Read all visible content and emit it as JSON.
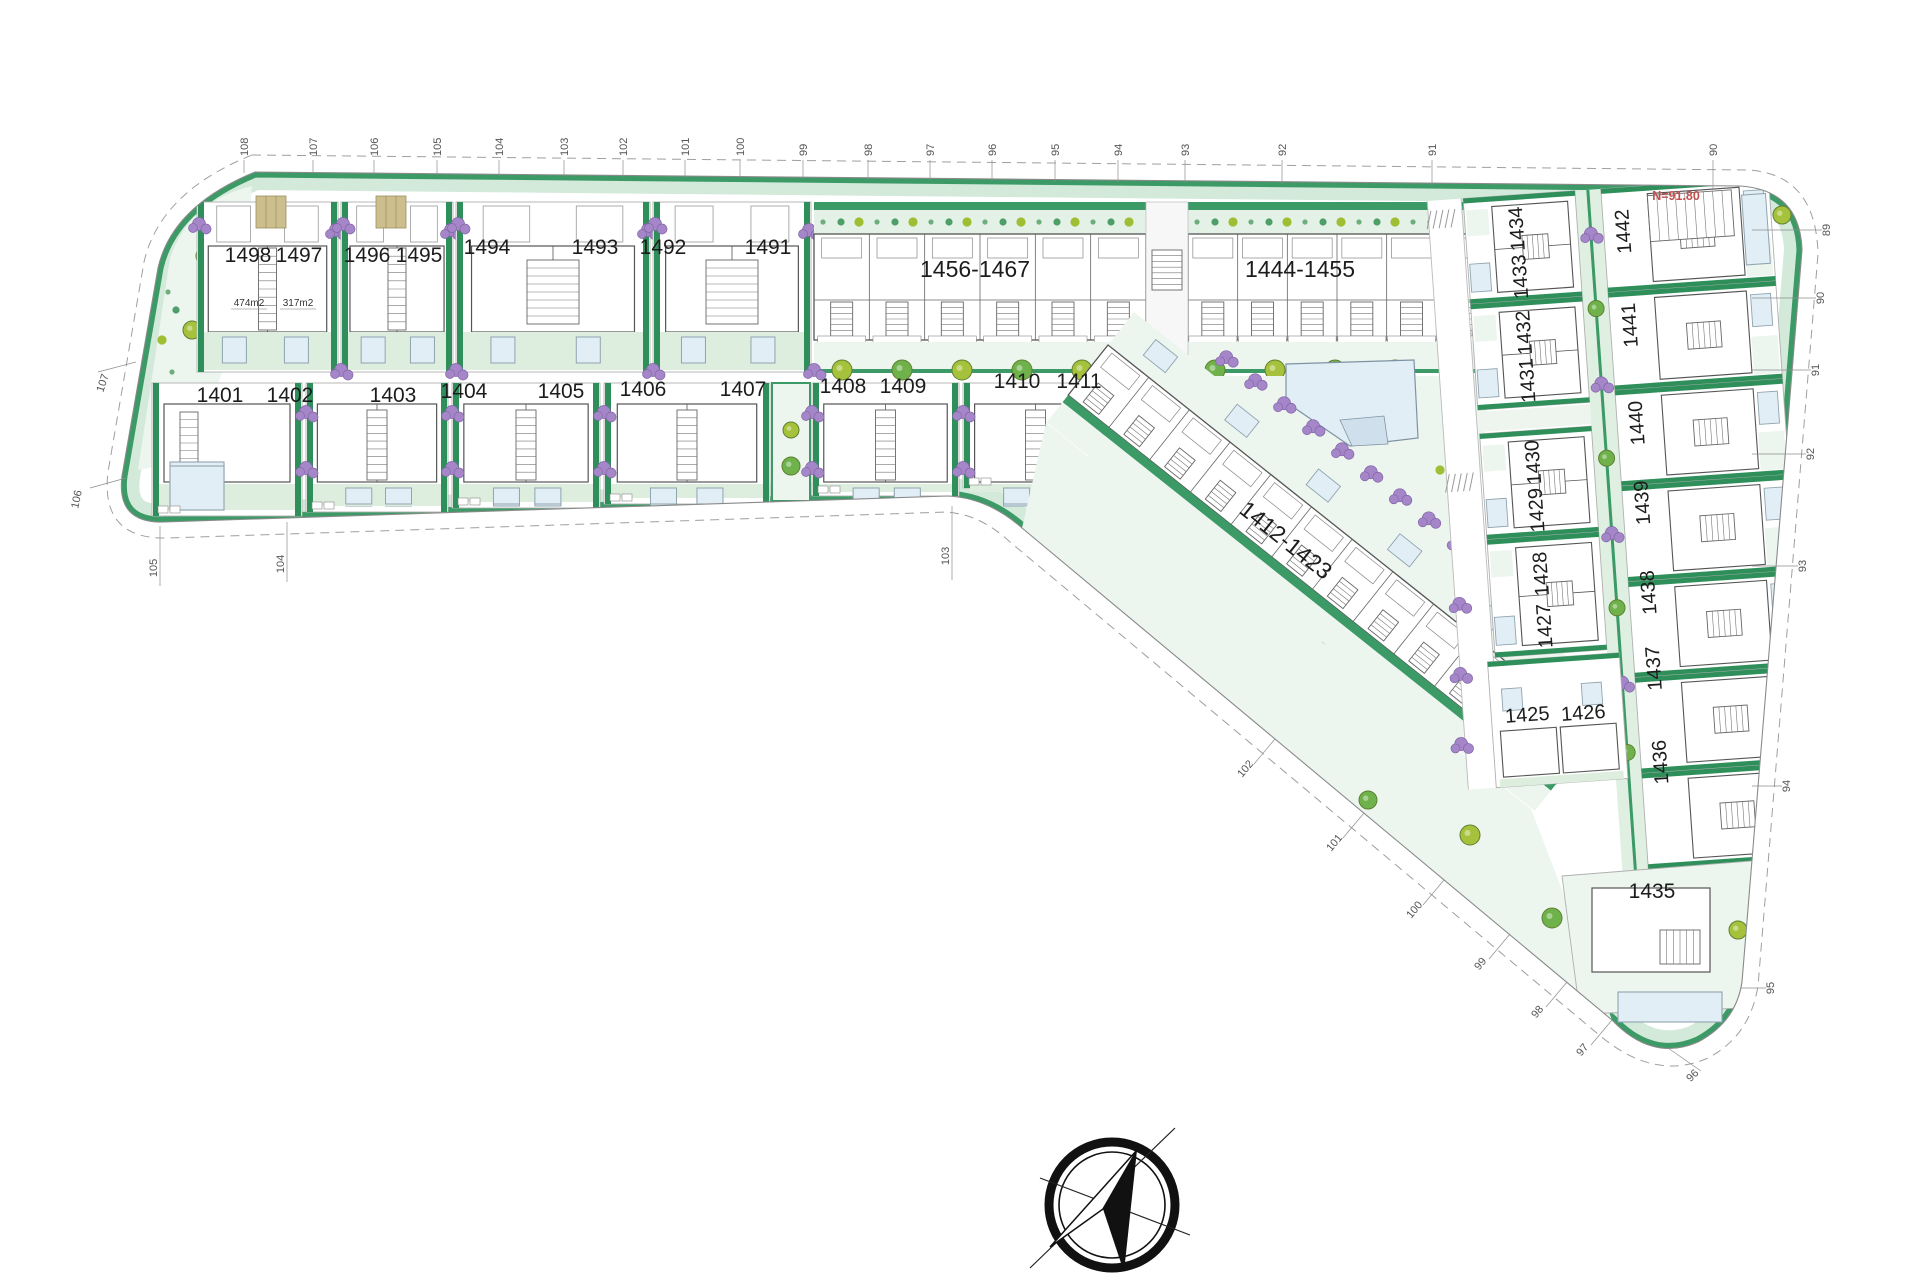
{
  "document": {
    "type": "residential development site plan",
    "background": "#ffffff"
  },
  "plots": {
    "row1_villas": [
      "1498",
      "1497",
      "1496",
      "1495",
      "1494",
      "1493",
      "1492",
      "1491"
    ],
    "row2_villas": [
      "1401",
      "1402",
      "1403",
      "1404",
      "1405",
      "1406",
      "1407",
      "1408",
      "1409",
      "1410",
      "1411"
    ],
    "apartment_blocks": [
      "1456-1467",
      "1444-1455",
      "1412-1423"
    ],
    "east_inner_column": [
      "1434",
      "1433",
      "1432",
      "1431",
      "1430",
      "1429",
      "1428",
      "1427"
    ],
    "east_inner_bottom_pair": [
      "1425",
      "1426"
    ],
    "east_outer_column": [
      "1442",
      "1441",
      "1440",
      "1439",
      "1438",
      "1437",
      "1436"
    ],
    "southeast_villa": "1435"
  },
  "annotations": {
    "plot_1498_area": "474m2",
    "plot_1497_area": "317m2",
    "level_note": "N=91.80"
  },
  "survey_ticks": {
    "top": [
      "108",
      "107",
      "106",
      "105",
      "104",
      "103",
      "102",
      "101",
      "100",
      "99",
      "98",
      "97",
      "96",
      "95",
      "94",
      "93",
      "92",
      "91",
      "90"
    ],
    "right": [
      "89",
      "90",
      "91",
      "92",
      "93",
      "94",
      "95"
    ],
    "diagonal": [
      "102",
      "101",
      "100",
      "99",
      "98",
      "97",
      "96"
    ],
    "bottom_bend": "103",
    "bottom_left": [
      "105",
      "104"
    ],
    "left": [
      "107",
      "106"
    ]
  },
  "compass": {
    "type": "north-arrow"
  },
  "colors": {
    "parcel_line": "#8a8a8a",
    "road_line": "#9f9f9f",
    "strip_green": "#3b9a66",
    "band_light": "#d3e9da",
    "hedge_green": "#2f8f5b",
    "garden_green": "#ddeede",
    "light_green": "#ecf5ee",
    "planting_green": "#5fae78",
    "pool_blue": "#e2eef6",
    "pool_stroke": "#8fa4b0",
    "shrub_purple": "#a587c9",
    "tree_yellow_green": "#a6c23c",
    "tree_green": "#6fb24c",
    "pergola_tan": "#cdbf8d",
    "building_stroke": "#555555",
    "lot_line": "#b0b0b0",
    "label_color": "#1c1c1c",
    "tick_color": "#555555",
    "level_red": "#c0504d"
  }
}
